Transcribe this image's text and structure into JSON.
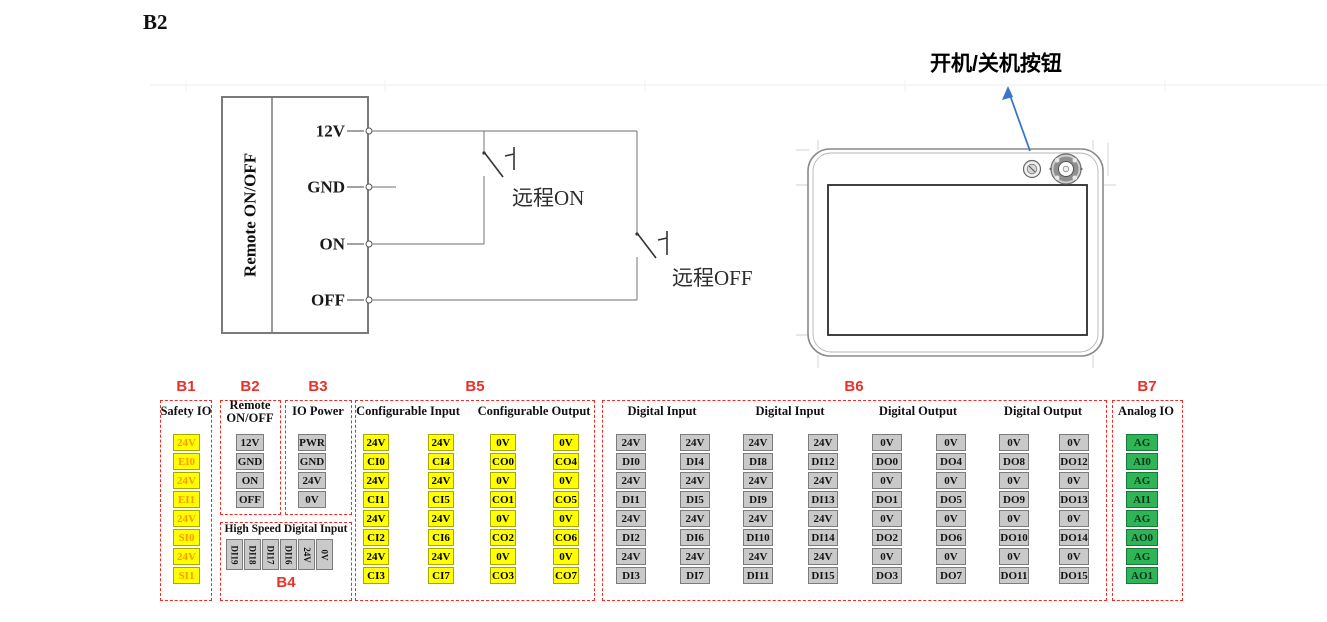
{
  "page": {
    "label": "B2"
  },
  "circuit": {
    "panel_label": "Remote ON/OFF",
    "terminals": [
      "12V",
      "GND",
      "ON",
      "OFF"
    ],
    "remote_on_label": "远程ON",
    "remote_off_label": "远程OFF"
  },
  "device": {
    "annotation": "开机/关机按钮"
  },
  "terminal_blocks": {
    "sections": [
      {
        "id": "B1",
        "title": "Safety IO",
        "palette": "safety",
        "columns": [
          [
            "24V",
            "EI0",
            "24V",
            "EI1",
            "24V",
            "SI0",
            "24V",
            "SI1"
          ]
        ]
      },
      {
        "id": "B2",
        "title": "Remote\nON/OFF",
        "palette": "gray",
        "columns": [
          [
            "12V",
            "GND",
            "ON",
            "OFF"
          ]
        ]
      },
      {
        "id": "B3",
        "title": "IO Power",
        "palette": "gray",
        "columns": [
          [
            "PWR",
            "GND",
            "24V",
            "0V"
          ]
        ]
      },
      {
        "id": "B4",
        "title": "High Speed Digital Input",
        "palette": "gray",
        "rotated": true,
        "columns": [
          [
            "DI19",
            "DI18",
            "DI17",
            "DI16",
            "24V",
            "0V"
          ]
        ]
      },
      {
        "id": "B5",
        "palette": "yellow",
        "groups": [
          {
            "title": "Configurable Input",
            "columns": [
              [
                "24V",
                "CI0",
                "24V",
                "CI1",
                "24V",
                "CI2",
                "24V",
                "CI3"
              ],
              [
                "24V",
                "CI4",
                "24V",
                "CI5",
                "24V",
                "CI6",
                "24V",
                "CI7"
              ]
            ]
          },
          {
            "title": "Configurable Output",
            "columns": [
              [
                "0V",
                "CO0",
                "0V",
                "CO1",
                "0V",
                "CO2",
                "0V",
                "CO3"
              ],
              [
                "0V",
                "CO4",
                "0V",
                "CO5",
                "0V",
                "CO6",
                "0V",
                "CO7"
              ]
            ]
          }
        ]
      },
      {
        "id": "B6",
        "palette": "gray",
        "groups": [
          {
            "title": "Digital Input",
            "columns": [
              [
                "24V",
                "DI0",
                "24V",
                "DI1",
                "24V",
                "DI2",
                "24V",
                "DI3"
              ],
              [
                "24V",
                "DI4",
                "24V",
                "DI5",
                "24V",
                "DI6",
                "24V",
                "DI7"
              ]
            ]
          },
          {
            "title": "Digital Input",
            "columns": [
              [
                "24V",
                "DI8",
                "24V",
                "DI9",
                "24V",
                "DI10",
                "24V",
                "DI11"
              ],
              [
                "24V",
                "DI12",
                "24V",
                "DI13",
                "24V",
                "DI14",
                "24V",
                "DI15"
              ]
            ]
          },
          {
            "title": "Digital Output",
            "columns": [
              [
                "0V",
                "DO0",
                "0V",
                "DO1",
                "0V",
                "DO2",
                "0V",
                "DO3"
              ],
              [
                "0V",
                "DO4",
                "0V",
                "DO5",
                "0V",
                "DO6",
                "0V",
                "DO7"
              ]
            ]
          },
          {
            "title": "Digital Output",
            "columns": [
              [
                "0V",
                "DO8",
                "0V",
                "DO9",
                "0V",
                "DO10",
                "0V",
                "DO11"
              ],
              [
                "0V",
                "DO12",
                "0V",
                "DO13",
                "0V",
                "DO14",
                "0V",
                "DO15"
              ]
            ]
          }
        ]
      },
      {
        "id": "B7",
        "title": "Analog IO",
        "palette": "green",
        "columns": [
          [
            "AG",
            "AI0",
            "AG",
            "AI1",
            "AG",
            "AO0",
            "AG",
            "AO1"
          ]
        ]
      }
    ],
    "colors": {
      "section_outline": "#EE2C24",
      "section_label": "#E8312A",
      "cell_yellow": "#FFFF00",
      "cell_yellow_border": "#A8A800",
      "cell_gray": "#C9C9C9",
      "cell_gray_border": "#7C7C7C",
      "cell_green": "#2FB457",
      "cell_green_border": "#157A36",
      "safety_text": "#FF9900",
      "annotation_arrow": "#3A76C8"
    }
  }
}
